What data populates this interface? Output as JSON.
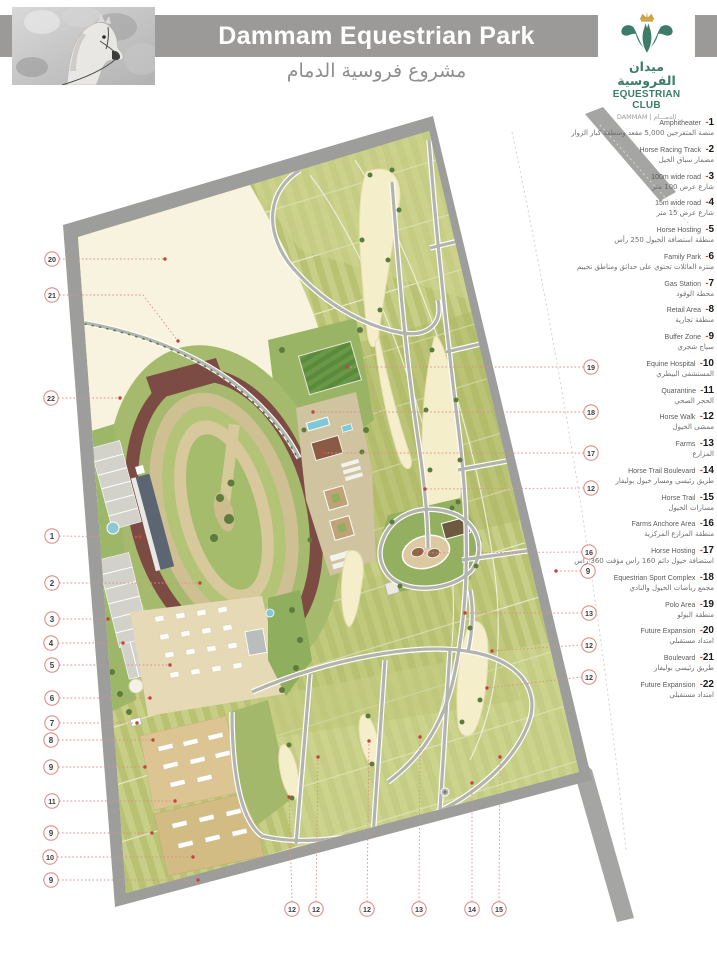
{
  "header": {
    "title": "Dammam Equestrian Park",
    "subtitle_ar": "مشروع فروسية الدمام",
    "photo_alt": "horse-photo",
    "logo": {
      "name_ar": "ميدان الفروسية",
      "name_en": "EQUESTRIAN CLUB",
      "location_line": "DAMMAM  |  الدمـــام"
    }
  },
  "legend": {
    "dash": "-",
    "items": [
      {
        "num": "1",
        "en": "Amphitheater",
        "ar": "منصة المتفرجين 5,000 مقعد ومنطقة كبار الزوار"
      },
      {
        "num": "2",
        "en": "Horse Racing Track",
        "ar": "مضمار سباق الخيل"
      },
      {
        "num": "3",
        "en": "100m wide road",
        "ar": "شارع عرض 100 متر"
      },
      {
        "num": "4",
        "en": "15m wide road",
        "ar": "شارع عرض 15 متر"
      },
      {
        "num": "5",
        "en": "Horse Hosting",
        "ar": "منطقة استضافة الخيول 250 رأس"
      },
      {
        "num": "6",
        "en": "Family Park",
        "ar": "منتزه العائلات تحتوي على حدائق ومناطق تخييم"
      },
      {
        "num": "7",
        "en": "Gas Station",
        "ar": "محطة الوقود"
      },
      {
        "num": "8",
        "en": "Retail Area",
        "ar": "منطقة تجارية"
      },
      {
        "num": "9",
        "en": "Buffer Zone",
        "ar": "سياج شجري"
      },
      {
        "num": "10",
        "en": "Equine Hospital",
        "ar": "المستشفى البيطري"
      },
      {
        "num": "11",
        "en": "Quarantine",
        "ar": "الحجر الصحي"
      },
      {
        "num": "12",
        "en": "Horse Walk",
        "ar": "ممشى الخيول"
      },
      {
        "num": "13",
        "en": "Farms",
        "ar": "المزارع"
      },
      {
        "num": "14",
        "en": "Horse Trail Boulevard",
        "ar": "طريق رئيسي ومسار خيول بوليفار"
      },
      {
        "num": "15",
        "en": "Horse Trail",
        "ar": "مسارات الخيول"
      },
      {
        "num": "16",
        "en": "Farms Anchore Area",
        "ar": "منطقة المزارع المركزية"
      },
      {
        "num": "17",
        "en": "Horse Hosting",
        "ar": "استضافة خيول دائم 160 راس مؤقت 360 راس"
      },
      {
        "num": "18",
        "en": "Equestrian Sport Complex",
        "ar": "مجمع رياضات الخيول والنادي"
      },
      {
        "num": "19",
        "en": "Polo Area",
        "ar": "منطقة البولو"
      },
      {
        "num": "20",
        "en": "Future Expansion",
        "ar": "امتداد مستقبلي"
      },
      {
        "num": "21",
        "en": "Boulevard",
        "ar": "طريق رئيسي بوليفار"
      },
      {
        "num": "22",
        "en": "Future Expansion",
        "ar": "امتداد مستقبلي"
      }
    ]
  },
  "map": {
    "callouts": [
      {
        "n": "20",
        "x": 52,
        "y": 259,
        "tx": 165,
        "ty": 259
      },
      {
        "n": "21",
        "x": 52,
        "y": 295,
        "mid": [
          143,
          295
        ],
        "tx": 178,
        "ty": 341
      },
      {
        "n": "22",
        "x": 51,
        "y": 398,
        "tx": 120,
        "ty": 398
      },
      {
        "n": "1",
        "x": 52,
        "y": 536,
        "tx": 140,
        "ty": 537
      },
      {
        "n": "2",
        "x": 52,
        "y": 583,
        "tx": 200,
        "ty": 583
      },
      {
        "n": "3",
        "x": 52,
        "y": 619,
        "tx": 108,
        "ty": 619
      },
      {
        "n": "4",
        "x": 51,
        "y": 643,
        "tx": 123,
        "ty": 643
      },
      {
        "n": "5",
        "x": 52,
        "y": 665,
        "tx": 170,
        "ty": 665
      },
      {
        "n": "6",
        "x": 52,
        "y": 698,
        "tx": 150,
        "ty": 698
      },
      {
        "n": "7",
        "x": 52,
        "y": 723,
        "tx": 137,
        "ty": 723
      },
      {
        "n": "8",
        "x": 51,
        "y": 740,
        "tx": 153,
        "ty": 740
      },
      {
        "n": "9",
        "x": 51,
        "y": 767,
        "tx": 145,
        "ty": 767
      },
      {
        "n": "11",
        "x": 52,
        "y": 801,
        "tx": 175,
        "ty": 801
      },
      {
        "n": "9",
        "x": 51,
        "y": 833,
        "tx": 152,
        "ty": 833
      },
      {
        "n": "10",
        "x": 50,
        "y": 857,
        "tx": 193,
        "ty": 857
      },
      {
        "n": "9",
        "x": 51,
        "y": 880,
        "tx": 198,
        "ty": 880
      },
      {
        "n": "19",
        "x": 591,
        "y": 367,
        "tx": 347,
        "ty": 367
      },
      {
        "n": "18",
        "x": 591,
        "y": 412,
        "tx": 313,
        "ty": 412
      },
      {
        "n": "17",
        "x": 591,
        "y": 453,
        "tx": 323,
        "ty": 453
      },
      {
        "n": "12",
        "x": 591,
        "y": 488,
        "tx": 425,
        "ty": 489
      },
      {
        "n": "16",
        "x": 589,
        "y": 552,
        "tx": 420,
        "ty": 553
      },
      {
        "n": "9",
        "x": 588,
        "y": 571,
        "tx": 556,
        "ty": 571
      },
      {
        "n": "13",
        "x": 589,
        "y": 613,
        "tx": 465,
        "ty": 613
      },
      {
        "n": "12",
        "x": 589,
        "y": 645,
        "tx": 492,
        "ty": 651
      },
      {
        "n": "12",
        "x": 589,
        "y": 677,
        "tx": 487,
        "ty": 688
      },
      {
        "n": "12",
        "x": 292,
        "y": 909,
        "tx": 289,
        "ty": 797
      },
      {
        "n": "12",
        "x": 316,
        "y": 909,
        "tx": 318,
        "ty": 757
      },
      {
        "n": "12",
        "x": 367,
        "y": 909,
        "tx": 369,
        "ty": 741
      },
      {
        "n": "13",
        "x": 419,
        "y": 909,
        "tx": 420,
        "ty": 737
      },
      {
        "n": "14",
        "x": 472,
        "y": 909,
        "tx": 472,
        "ty": 783
      },
      {
        "n": "15",
        "x": 499,
        "y": 909,
        "tx": 500,
        "ty": 757
      }
    ]
  },
  "colors": {
    "header_bar": "#9b9a98",
    "logo_green": "#3d7c68",
    "logo_gold": "#c9a243",
    "road_gray": "#9d9d9b",
    "farm_olive": "#bcc477",
    "cream": "#f8f3de",
    "track_maroon": "#7c4b43",
    "callout_red": "#dd8f88",
    "callout_dot": "#c2463d",
    "water_blue": "#82c7d8"
  }
}
